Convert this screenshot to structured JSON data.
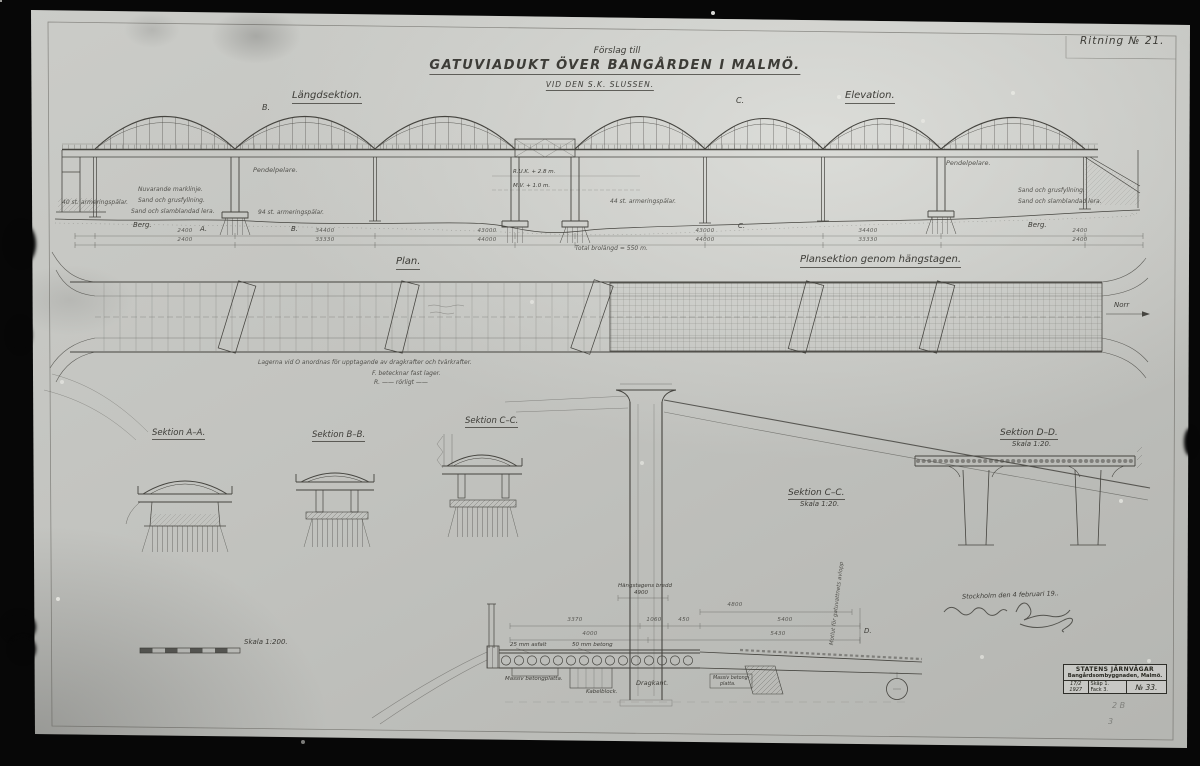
{
  "photo": {
    "ritning": "Ritning № 21."
  },
  "title": {
    "pretext": "Förslag till",
    "main": "GATUVIADUKT  ÖVER  BANGÅRDEN  I  MALMÖ.",
    "sub": "VID DEN S.K. SLUSSEN."
  },
  "views": {
    "langdsektion": "Längdsektion.",
    "elevation": "Elevation.",
    "plan": "Plan.",
    "plansektion": "Plansektion genom hängstagen.",
    "sektion_aa": "Sektion A–A.",
    "sektion_bb": "Sektion B–B.",
    "sektion_cc_small": "Sektion C–C.",
    "sektion_cc_large": "Sektion C–C.",
    "sektion_cc_skala": "Skala 1:20.",
    "sektion_dd": "Sektion D–D.",
    "sektion_dd_skala": "Skala 1:20.",
    "skala_1200": "Skala 1:200."
  },
  "annotations": {
    "pendelpelare_l": "Pendelpelare.",
    "pendelpelare_r": "Pendelpelare.",
    "marklinje": "Nuvarande marklinje.",
    "sand_grus_l": "Sand och grusfyllning.",
    "sand_lera_l": "Sand och slamblandad lera.",
    "sand_grus_r": "Sand och grusfyllning.",
    "sand_lera_r": "Sand och slamblandad lera.",
    "berg_l": "Berg.",
    "berg_r": "Berg.",
    "palar_l": "40 st. armeringspålar.",
    "palar_m": "44 st. armeringspålar.",
    "palar_r": "94 st. armeringspålar.",
    "ruk": "R.U.K. + 2.8 m.",
    "mv": "M.V. + 1.0 m.",
    "lager1": "Lagerna vid Ö anordnas för upptagande av dragkrafter och tvärkrafter.",
    "lager2": "F. betecknar fast lager.",
    "lager3": "R.  ——  rörligt  ——",
    "motlut": "Motlut för gatuvattnets avlopp",
    "asfalt": "25 mm asfalt",
    "betong": "50 mm betong",
    "massiv_l": "Massiv betongplatta.",
    "kabelblock": "Kabelblock.",
    "dragkant": "Dragkant.",
    "massiv_r1": "Massiv betong-",
    "massiv_r2": "platta."
  },
  "markers": {
    "a": "A.",
    "b": "B.",
    "b_top": "B.",
    "c_top": "C.",
    "c": "C.",
    "d": "D.",
    "norr": "Norr"
  },
  "dims": {
    "top": [
      "2400",
      "34400",
      "43000",
      "43000",
      "34400",
      "2400"
    ],
    "bottom": [
      "2400",
      "33330",
      "44000",
      "44000",
      "33330",
      "2400"
    ],
    "total": "Total brolängd = 550 m.",
    "sec": [
      "3370",
      "1060",
      "450",
      "4000",
      "4800",
      "5400",
      "5430"
    ],
    "hangstag1": "Hängstagens bredd",
    "hangstag2": "4900"
  },
  "signature": {
    "place_date": "Stockholm den 4 februari 19.."
  },
  "stamp": {
    "line1": "STATENS JÄRNVÄGAR",
    "line2": "Bangårdsombyggnaden, Malmö.",
    "date1": "17/2",
    "date2": "1927",
    "skap": "Skåp 1.",
    "fack": "Fack 3.",
    "no": "№ 33."
  },
  "pencil": {
    "p1": "2 B",
    "p2": "3"
  }
}
